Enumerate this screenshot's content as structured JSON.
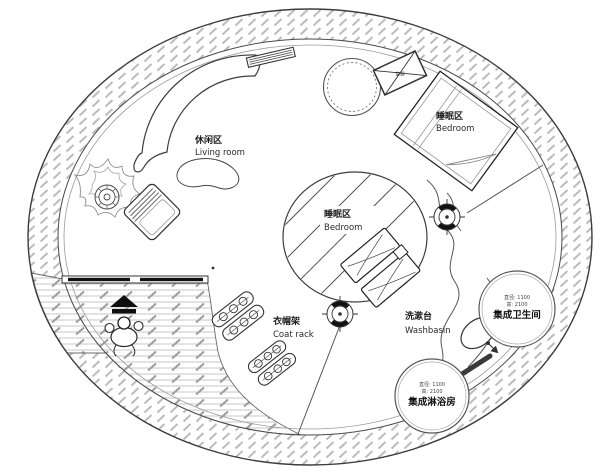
{
  "areas": {
    "living": {
      "zh": "休闲区",
      "en": "Living room"
    },
    "bedroom_upper": {
      "zh": "睡眠区",
      "en": "Bedroom"
    },
    "bedroom_center": {
      "zh": "睡眠区",
      "en": "Bedroom"
    },
    "coat_rack": {
      "zh": "衣帽架",
      "en": "Coat rack"
    },
    "washbasin": {
      "zh": "洗漱台",
      "en": "Washbasin"
    }
  },
  "pods": {
    "toilet": {
      "spec_line1": "直径: 1100",
      "spec_line2": "高: 2100",
      "name": "集成卫生间"
    },
    "shower": {
      "spec_line1": "直径: 1100",
      "spec_line2": "高: 2100",
      "name": "集成淋浴房"
    }
  },
  "equipment": {
    "ac_label": "空调"
  },
  "colors": {
    "wall_line": "#3d3d3d",
    "ring_hatch": "#bcbcbc",
    "deck_hatch": "#b5b5b5",
    "text_dark": "#1c1c1c"
  }
}
